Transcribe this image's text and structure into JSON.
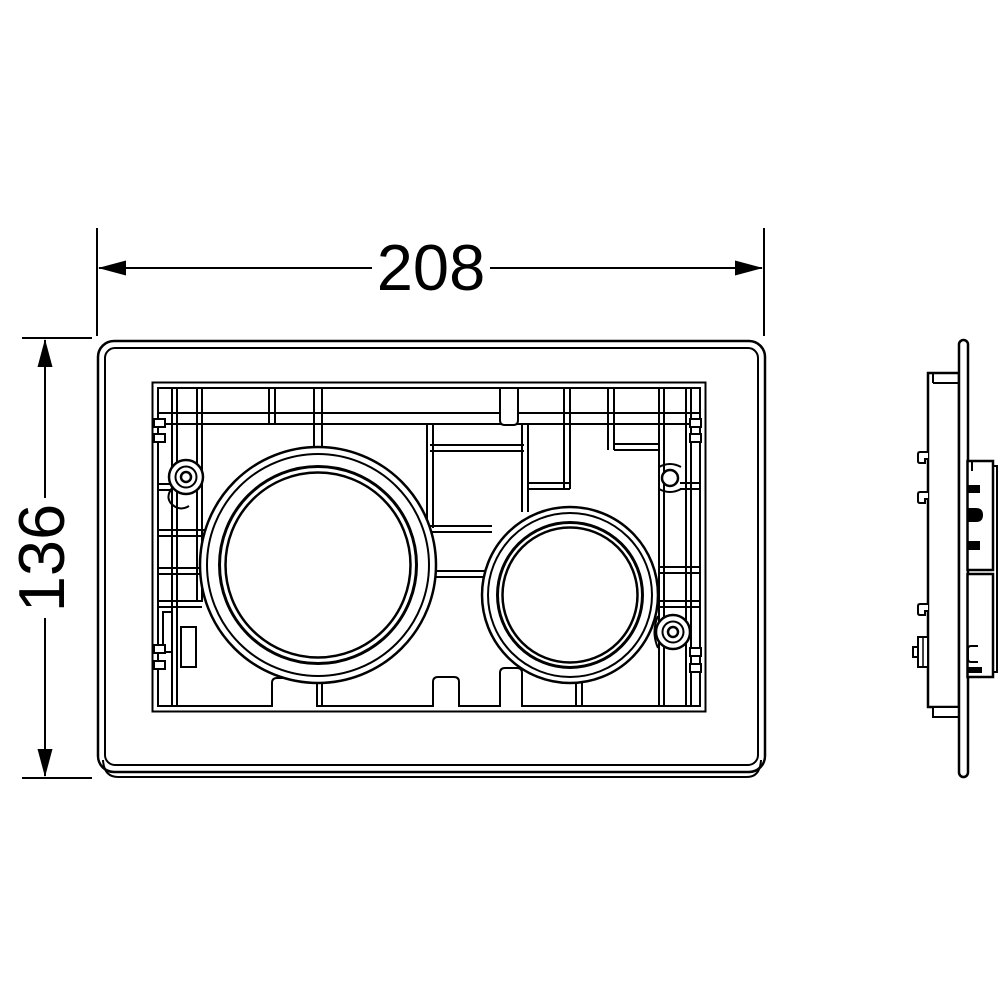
{
  "drawing": {
    "kind": "technical-drawing",
    "dimensions": {
      "width_label": "208",
      "height_label": "136"
    },
    "colors": {
      "line": "#000000",
      "background": "#ffffff"
    }
  }
}
